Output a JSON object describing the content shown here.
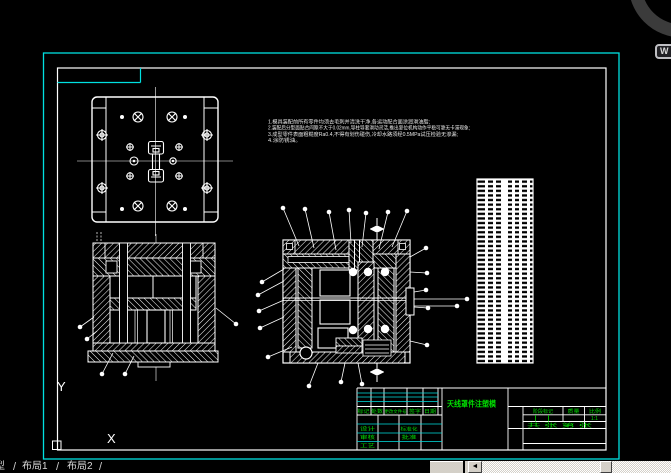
{
  "tabs": {
    "model": "型",
    "layout1": "布局1",
    "layout2": "布局2",
    "sep": "/"
  },
  "scrollbar": {
    "left_arrow": "◄"
  },
  "nav": {
    "key_hint": "W"
  },
  "ucs": {
    "x_label": "X",
    "y_label": "Y"
  },
  "notes": {
    "line1": "1.模具装配前所有零件均须去毛刺并清洗干净,各运动配合面涂润滑油脂;",
    "line2": "2.装配后分型面贴合间隙不大于0.02mm,导柱导套滑动灵活,推出复位机构动作平稳可靠无卡滞现象;",
    "line3": "3.成型零件表面粗糙度Ra0.4,不得有划伤碰伤,冷却水路须经0.5MPa试压检验无渗漏;",
    "line4": "4.涂防锈油。"
  },
  "title_block": {
    "drawing_title": "天线罩件注塑模",
    "rev": {
      "mark": "标记",
      "count": "处数",
      "file": "更改文件号",
      "sign": "签字",
      "date": "日期"
    },
    "roles": {
      "design": "设计",
      "standardization": "标准化",
      "check": "审核",
      "approve": "批准",
      "process": "工艺"
    },
    "stage": {
      "stage_mark": "阶段标记",
      "weight": "质量",
      "scale": "比例",
      "scale_value": "1:1",
      "sheet_info": "共 张 第 张"
    }
  },
  "colors": {
    "accent_cyan": "#00e0e0",
    "annotation_green": "#00dd00",
    "line_white": "#ffffff",
    "chrome_gray": "#d4d0c8"
  }
}
